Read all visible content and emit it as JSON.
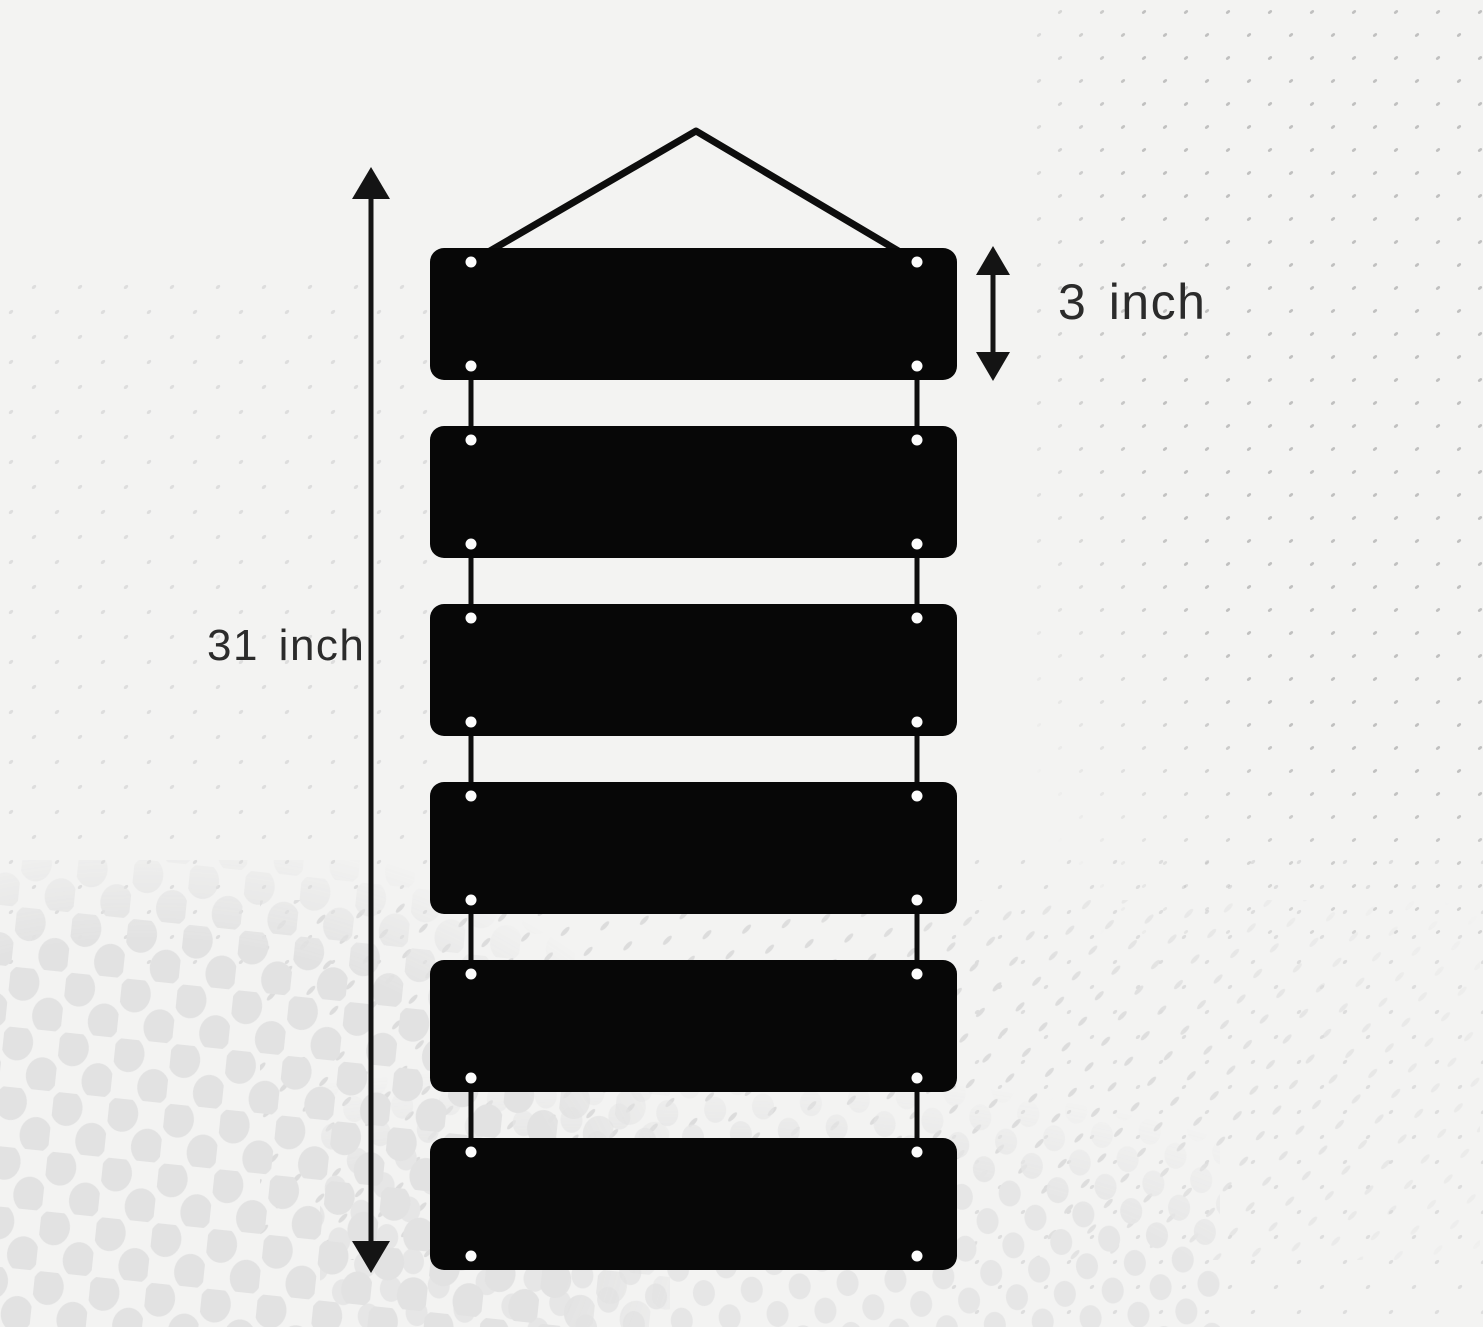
{
  "diagram": {
    "subject": "hanging wall sign with six blank rectangular planks connected by strings",
    "plank_count": 6
  },
  "labels": {
    "total_height": "31 inch",
    "plank_height": "3 inch"
  },
  "colors": {
    "background": "#f3f3f2",
    "plank": "#070707",
    "string": "#0d0d0d",
    "arrow": "#141414",
    "text": "#2b2b2b",
    "hole": "#fcfcfc",
    "dots_large": "#e2e2e2"
  }
}
